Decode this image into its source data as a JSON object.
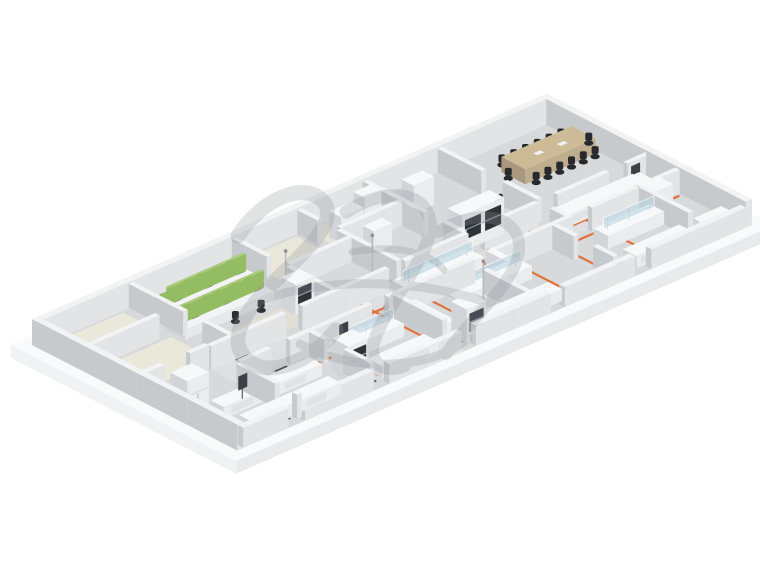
{
  "scene": {
    "background": "#ffffff",
    "projection": {
      "origin": [
        32,
        345
      ],
      "ua": [
        0.468,
        -0.205
      ],
      "ub": [
        0.4275,
        0.2198
      ],
      "a_max": 1100,
      "b_max": 480
    },
    "palette": {
      "slab_top": "#f9fafb",
      "slab_front": "#e8eaeb",
      "slab_side": "#f1f2f3",
      "floor": "#d7d9db",
      "corridor": "#dddfe1",
      "wall_top": "#f1f3f4",
      "wall_left": "#c6cacd",
      "wall_right": "#e2e4e6",
      "furn_top": "#f7f8f9",
      "furn_left": "#d2d5d8",
      "furn_right": "#eaecee",
      "desk_top": "#f2f4f5",
      "desk_left": "#cfd3d6",
      "desk_right": "#e6e8ea",
      "panel_top": "#a9cc7a",
      "panel_left": "#7da24f",
      "panel_right": "#94bc62",
      "wood_top": "#cdbb98",
      "wood_left": "#a9987d",
      "wood_right": "#bfae8e",
      "chair": "#2c2f33",
      "chair_back": "#383c40",
      "conf_chair": "#27292d",
      "window": "#2e3338",
      "sash": "#a9b6bd",
      "glass": "rgba(187,214,225,0.6)",
      "glass_edge": "rgba(255,255,255,0.85)",
      "mat": "#35393c",
      "orange": "#e2703a",
      "screen": "#3a4046",
      "pole": "#b7bbbe",
      "monitor": "#2f3337"
    },
    "slab": {
      "outer": [
        -24,
        -24,
        1124,
        504
      ],
      "thickness": 13
    },
    "floor": {
      "rect": [
        0,
        0,
        1100,
        480
      ]
    },
    "corridor": {
      "rect": [
        150,
        255,
        1087,
        315
      ]
    },
    "floor_patches": [
      {
        "rect": [
          20,
          18,
          178,
          106
        ],
        "color": "#eae7db"
      },
      {
        "rect": [
          20,
          130,
          178,
          232
        ],
        "color": "#eae7db"
      },
      {
        "rect": [
          432,
          18,
          548,
          108
        ],
        "color": "#eae7db"
      },
      {
        "rect": [
          572,
          18,
          688,
          88
        ],
        "color": "#e7e4d9"
      },
      {
        "rect": [
          212,
          178,
          408,
          238
        ],
        "color": "#e2dfd5"
      },
      {
        "rect": [
          310,
          15,
          408,
          100
        ],
        "color": "#e0ddd3"
      }
    ],
    "walls": {
      "segments": [
        [
          0,
          0,
          1100,
          13,
          26
        ],
        [
          1087,
          13,
          1100,
          480,
          26
        ],
        [
          0,
          13,
          13,
          480,
          26
        ],
        [
          13,
          467,
          110,
          480,
          20
        ],
        [
          145,
          467,
          290,
          480,
          20
        ],
        [
          325,
          467,
          480,
          480,
          20
        ],
        [
          510,
          467,
          670,
          480,
          20
        ],
        [
          700,
          467,
          850,
          480,
          20
        ],
        [
          885,
          467,
          1087,
          480,
          20
        ],
        [
          150,
          245,
          310,
          255,
          24
        ],
        [
          345,
          245,
          530,
          255,
          24
        ],
        [
          565,
          245,
          700,
          255,
          24
        ],
        [
          735,
          245,
          850,
          255,
          24
        ],
        [
          890,
          245,
          1000,
          255,
          24
        ],
        [
          1040,
          245,
          1087,
          255,
          24
        ],
        [
          150,
          315,
          215,
          325,
          24
        ],
        [
          255,
          315,
          430,
          325,
          24
        ],
        [
          465,
          315,
          650,
          325,
          24
        ],
        [
          690,
          315,
          855,
          325,
          24
        ],
        [
          900,
          315,
          1000,
          325,
          24
        ],
        [
          1040,
          315,
          1087,
          325,
          24
        ],
        [
          13,
          113,
          160,
          123,
          24
        ],
        [
          13,
          240,
          55,
          250,
          24
        ],
        [
          110,
          240,
          150,
          250,
          24
        ],
        [
          195,
          13,
          205,
          140,
          24
        ],
        [
          195,
          185,
          205,
          245,
          24
        ],
        [
          415,
          13,
          425,
          95,
          24
        ],
        [
          415,
          140,
          425,
          245,
          24
        ],
        [
          555,
          13,
          565,
          60,
          24
        ],
        [
          555,
          105,
          565,
          245,
          24
        ],
        [
          695,
          13,
          705,
          155,
          24
        ],
        [
          695,
          200,
          705,
          245,
          24
        ],
        [
          855,
          13,
          865,
          115,
          24
        ],
        [
          855,
          165,
          865,
          245,
          24
        ],
        [
          425,
          130,
          555,
          140,
          24
        ],
        [
          565,
          95,
          695,
          105,
          24
        ],
        [
          140,
          325,
          150,
          415,
          24
        ],
        [
          140,
          455,
          150,
          467,
          24
        ],
        [
          295,
          325,
          305,
          360,
          24
        ],
        [
          295,
          405,
          305,
          467,
          24
        ],
        [
          475,
          325,
          485,
          440,
          24
        ],
        [
          635,
          360,
          645,
          467,
          24
        ],
        [
          815,
          325,
          825,
          375,
          24
        ],
        [
          815,
          420,
          825,
          467,
          24
        ],
        [
          1000,
          325,
          1010,
          440,
          24
        ],
        [
          850,
          280,
          860,
          325,
          24
        ]
      ]
    },
    "utility_lines": {
      "color": "#e2703a",
      "width": 2.2,
      "paths": [
        [
          [
            432,
            288
          ],
          [
            1080,
            288
          ]
        ],
        [
          [
            470,
            255
          ],
          [
            470,
            460
          ]
        ],
        [
          [
            560,
            255
          ],
          [
            560,
            460
          ]
        ],
        [
          [
            650,
            255
          ],
          [
            650,
            440
          ]
        ],
        [
          [
            740,
            255
          ],
          [
            740,
            460
          ]
        ],
        [
          [
            830,
            255
          ],
          [
            830,
            460
          ]
        ],
        [
          [
            920,
            255
          ],
          [
            920,
            460
          ]
        ],
        [
          [
            1010,
            255
          ],
          [
            1010,
            440
          ]
        ],
        [
          [
            620,
            228
          ],
          [
            800,
            228
          ]
        ],
        [
          [
            58,
            352
          ],
          [
            332,
            352
          ]
        ],
        [
          [
            58,
            424
          ],
          [
            308,
            424
          ]
        ],
        [
          [
            332,
            330
          ],
          [
            332,
            446
          ]
        ],
        [
          [
            152,
            330
          ],
          [
            152,
            424
          ]
        ],
        [
          [
            865,
            330
          ],
          [
            1080,
            330
          ]
        ],
        [
          [
            950,
            255
          ],
          [
            950,
            330
          ]
        ]
      ]
    },
    "mats": {
      "size": [
        26,
        16
      ],
      "positions": [
        [
          322,
          300
        ],
        [
          506,
          290
        ],
        [
          592,
          298
        ],
        [
          668,
          254
        ],
        [
          700,
          310
        ],
        [
          234,
          332
        ],
        [
          424,
          332
        ],
        [
          120,
          452
        ],
        [
          304,
          452
        ],
        [
          492,
          448
        ],
        [
          682,
          444
        ],
        [
          862,
          438
        ],
        [
          1048,
          300
        ],
        [
          214,
          252
        ],
        [
          868,
          140
        ],
        [
          940,
          445
        ]
      ]
    },
    "furniture": [
      {
        "type": "wsrow",
        "a": 205,
        "b": 48,
        "len": 190
      },
      {
        "type": "wsrow",
        "a": 188,
        "b": 108,
        "len": 190
      },
      {
        "type": "fumehood",
        "a": 372,
        "b": 175,
        "la": 40,
        "lb": 34,
        "h": 30
      },
      {
        "type": "cabinet",
        "a": 585,
        "b": 55,
        "la": 48,
        "lb": 28,
        "h": 26
      },
      {
        "type": "cabinet",
        "a": 645,
        "b": 46,
        "la": 36,
        "lb": 26,
        "h": 31
      },
      {
        "type": "cabinet",
        "a": 600,
        "b": 118,
        "la": 40,
        "lb": 24,
        "h": 22
      },
      {
        "type": "cabinet",
        "a": 735,
        "b": 60,
        "la": 44,
        "lb": 28,
        "h": 28
      },
      {
        "type": "conference",
        "a": 930,
        "b": 80,
        "la": 150,
        "lb": 56,
        "h": 15
      },
      {
        "type": "bench",
        "a": 880,
        "b": 255,
        "la": 170,
        "lb": 32,
        "h": 12
      },
      {
        "type": "bench",
        "a": 1030,
        "b": 258,
        "la": 32,
        "lb": 66,
        "h": 12
      },
      {
        "type": "fridge",
        "a": 990,
        "b": 330,
        "la": 44,
        "lb": 38,
        "h": 30
      },
      {
        "type": "screen",
        "a": 1045,
        "b": 262
      },
      {
        "type": "doublefume",
        "a": 705,
        "b": 200,
        "la": 90,
        "lb": 34,
        "h": 36
      },
      {
        "type": "glassbench",
        "a": 530,
        "b": 262,
        "la": 160,
        "lb": 38,
        "h": 13
      },
      {
        "type": "glassbench",
        "a": 565,
        "b": 338,
        "la": 160,
        "lb": 38,
        "h": 13
      },
      {
        "type": "cylrack",
        "a": 668,
        "b": 330,
        "la": 14,
        "lb": 58,
        "h": 30
      },
      {
        "type": "bench",
        "a": 490,
        "b": 330,
        "la": 28,
        "lb": 95,
        "h": 12
      },
      {
        "type": "fumehood",
        "a": 505,
        "b": 428,
        "la": 42,
        "lb": 36,
        "h": 34
      },
      {
        "type": "bench",
        "a": 552,
        "b": 430,
        "la": 158,
        "lb": 32,
        "h": 12
      },
      {
        "type": "fridge",
        "a": 26,
        "b": 295,
        "la": 46,
        "lb": 40,
        "h": 32
      },
      {
        "type": "bench",
        "a": 55,
        "b": 358,
        "la": 210,
        "lb": 30,
        "h": 12
      },
      {
        "type": "bench",
        "a": 55,
        "b": 424,
        "la": 190,
        "lb": 30,
        "h": 12
      },
      {
        "type": "fumehood",
        "a": 285,
        "b": 390,
        "la": 44,
        "lb": 38,
        "h": 34
      },
      {
        "type": "bench",
        "a": 330,
        "b": 424,
        "la": 120,
        "lb": 34,
        "h": 12
      },
      {
        "type": "glassbench",
        "a": 318,
        "b": 344,
        "la": 130,
        "lb": 36,
        "h": 13
      },
      {
        "type": "glassbench",
        "a": 880,
        "b": 350,
        "la": 120,
        "lb": 34,
        "h": 13
      },
      {
        "type": "bench",
        "a": 870,
        "b": 430,
        "la": 120,
        "lb": 32,
        "h": 12
      },
      {
        "type": "bench",
        "a": 1020,
        "b": 430,
        "la": 60,
        "lb": 32,
        "h": 12
      },
      {
        "type": "screen",
        "a": 120,
        "b": 356
      },
      {
        "type": "screen",
        "a": 352,
        "b": 338
      },
      {
        "type": "pole",
        "a": 405,
        "b": 150
      },
      {
        "type": "pole",
        "a": 540,
        "b": 205
      },
      {
        "type": "pole",
        "a": 610,
        "b": 388
      }
    ],
    "watermark": {
      "color": "#8d9398",
      "opacity": 0.26,
      "strokes": [
        {
          "d": "M238,236 C262,198 304,182 322,200 C342,220 304,252 272,284 C240,316 226,344 250,362 C272,378 312,360 336,330",
          "w": 15
        },
        {
          "d": "M346,212 C386,186 426,192 430,222 C434,254 386,302 374,342 C368,362 382,374 404,366",
          "w": 13
        },
        {
          "d": "M438,232 C478,206 522,216 519,250 C516,284 468,320 446,354",
          "w": 12
        },
        {
          "d": "M262,300 C330,276 420,280 486,302",
          "w": 9
        },
        {
          "d": "M352,252 C396,244 430,252 444,270",
          "w": 7
        },
        {
          "d": "M300,344 C350,372 430,372 468,338",
          "w": 9
        }
      ]
    }
  }
}
